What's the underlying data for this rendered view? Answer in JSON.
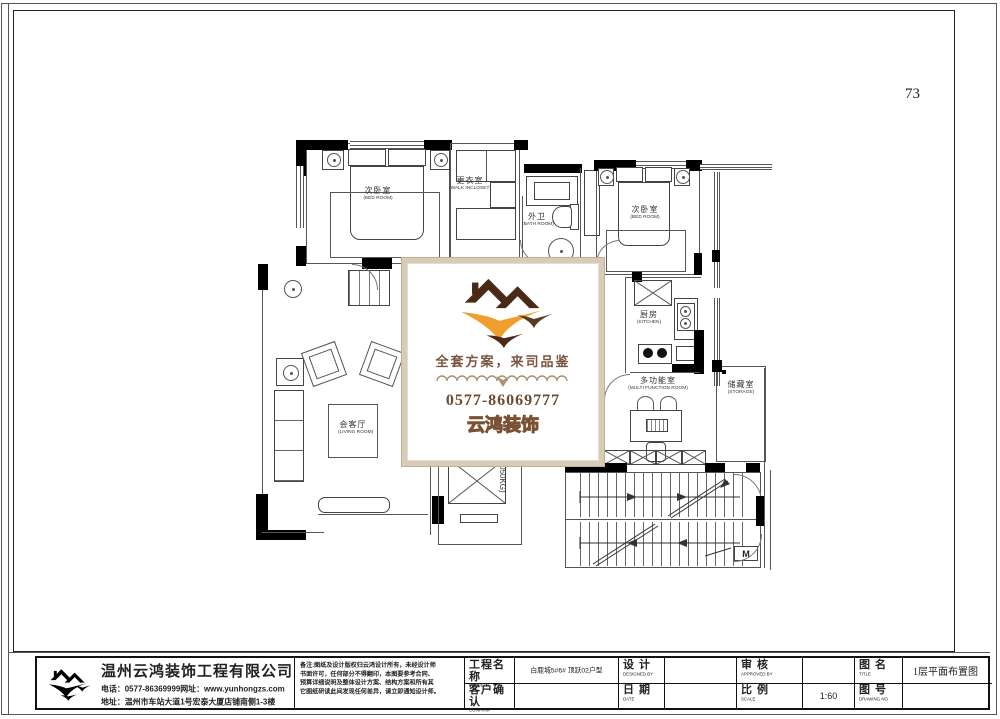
{
  "page": {
    "number": "73"
  },
  "watermark": {
    "slogan": "全套方案，来司品鉴",
    "phone": "0577-86069777",
    "brand": "云鸿装饰",
    "colors": {
      "gold": "#f09f2e",
      "roof_brown": "#4a2a16",
      "slogan_brown": "#7a5640",
      "phone_brown": "#6e4a2f",
      "frame_tan": "#d9ccb6"
    }
  },
  "plan": {
    "elevator_capacity": "(1050KG)",
    "machine_room_label": "M"
  },
  "rooms": [
    {
      "id": "bedroom-left",
      "cn": "次卧室",
      "en": "(BED ROOM)"
    },
    {
      "id": "walk-in-closet",
      "cn": "更衣室",
      "en": "(WALK INCLOSET)"
    },
    {
      "id": "bathroom",
      "cn": "外卫",
      "en": "(BATH ROOM)"
    },
    {
      "id": "bedroom-right",
      "cn": "次卧室",
      "en": "(BED ROOM)"
    },
    {
      "id": "kitchen",
      "cn": "厨房",
      "en": "(KITCHEN)"
    },
    {
      "id": "multi-function-room",
      "cn": "多功能室",
      "en": "(MULTI FUNCTION ROOM)"
    },
    {
      "id": "storage",
      "cn": "储藏室",
      "en": "(STORAGE)"
    },
    {
      "id": "living-room",
      "cn": "会客厅",
      "en": "(LIVING ROOM)"
    }
  ],
  "title_block": {
    "company": {
      "name": "温州云鸿装饰工程有限公司",
      "phone_line": "电话：0577-86369999网址：www.yunhongzs.com",
      "address_line": "地址：温州市车站大道1号宏泰大厦店铺南侧1-3楼"
    },
    "notes": [
      "备注:图纸及设计版权归云鸿设计所有，未经设计师",
      "书面许可，任何部分不得翻印，本图要参考合同、",
      "预算详细说明及整体设计方案、结构方案和所有其",
      "它图纸研读此间发现任何差异，请立即通知设计师。"
    ],
    "fields": {
      "project_label_cn": "工程名称",
      "project_label_en": "PROJECT",
      "project_value": "白鹿城5#6# 顶跃02户型",
      "design_label_cn": "设 计",
      "design_label_en": "DESIGNED BY",
      "design_value": "",
      "approved_label_cn": "审 核",
      "approved_label_en": "APPROVED BY",
      "approved_value": "",
      "drawing_name_label_cn": "图 名",
      "drawing_name_label_en": "TITLE",
      "drawing_name_value": "1层平面布置图",
      "confirm_label_cn": "客户确认",
      "confirm_label_en": "CONFIRM",
      "confirm_value": "",
      "date_label_cn": "日 期",
      "date_label_en": "DATE",
      "date_value": "",
      "scale_label_cn": "比 例",
      "scale_label_en": "SCALE",
      "scale_value": "1:60",
      "drawing_no_label_cn": "图 号",
      "drawing_no_label_en": "DRAWING NO",
      "drawing_no_value": ""
    }
  }
}
